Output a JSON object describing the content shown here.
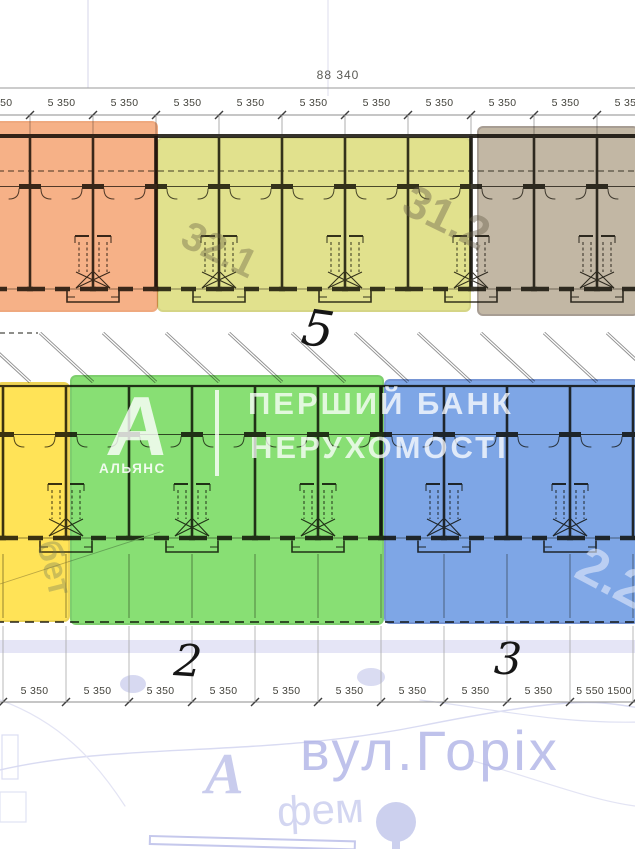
{
  "dimensions": {
    "total_width_label": "88 340",
    "top_segment_labels": [
      "5 350",
      "5 350",
      "5 350",
      "5 350",
      "5 350",
      "5 350",
      "5 350",
      "5 350",
      "5 350",
      "5 350",
      "5 350"
    ],
    "bottom_segment_labels": [
      "5 350",
      "5 350",
      "5 350",
      "5 350",
      "5 350",
      "5 350",
      "5 350",
      "5 350",
      "5 350",
      "5 550 1500"
    ]
  },
  "handwritten_marks": {
    "top_row_number": "5",
    "bottom_left_number": "2",
    "bottom_right_number": "3"
  },
  "plan_watermark_numbers": {
    "olive_block": "32.1",
    "brown_block": "31.2",
    "yellow_block": "бет",
    "blue_block": "2.2"
  },
  "brand_watermark": {
    "logo_letter": "А",
    "logo_caption": "АЛЬЯНС",
    "line1": "ПЕРШИЙ БАНК",
    "line2": "НЕРУХОМОСТІ"
  },
  "map_background": {
    "street_name": "вул.Горіх",
    "block_letter": "А",
    "small_label": "фем"
  },
  "colors": {
    "orange_block": "#f2a977",
    "olive_block": "#dada78",
    "brown_block": "#b4a38a",
    "yellow_block": "#ffe14d",
    "green_block": "#7fdc66",
    "blue_block": "#6f9ce2",
    "plan_line": "#3b382f",
    "map_lavender": "#c5c8ec",
    "ink": "#161616"
  }
}
